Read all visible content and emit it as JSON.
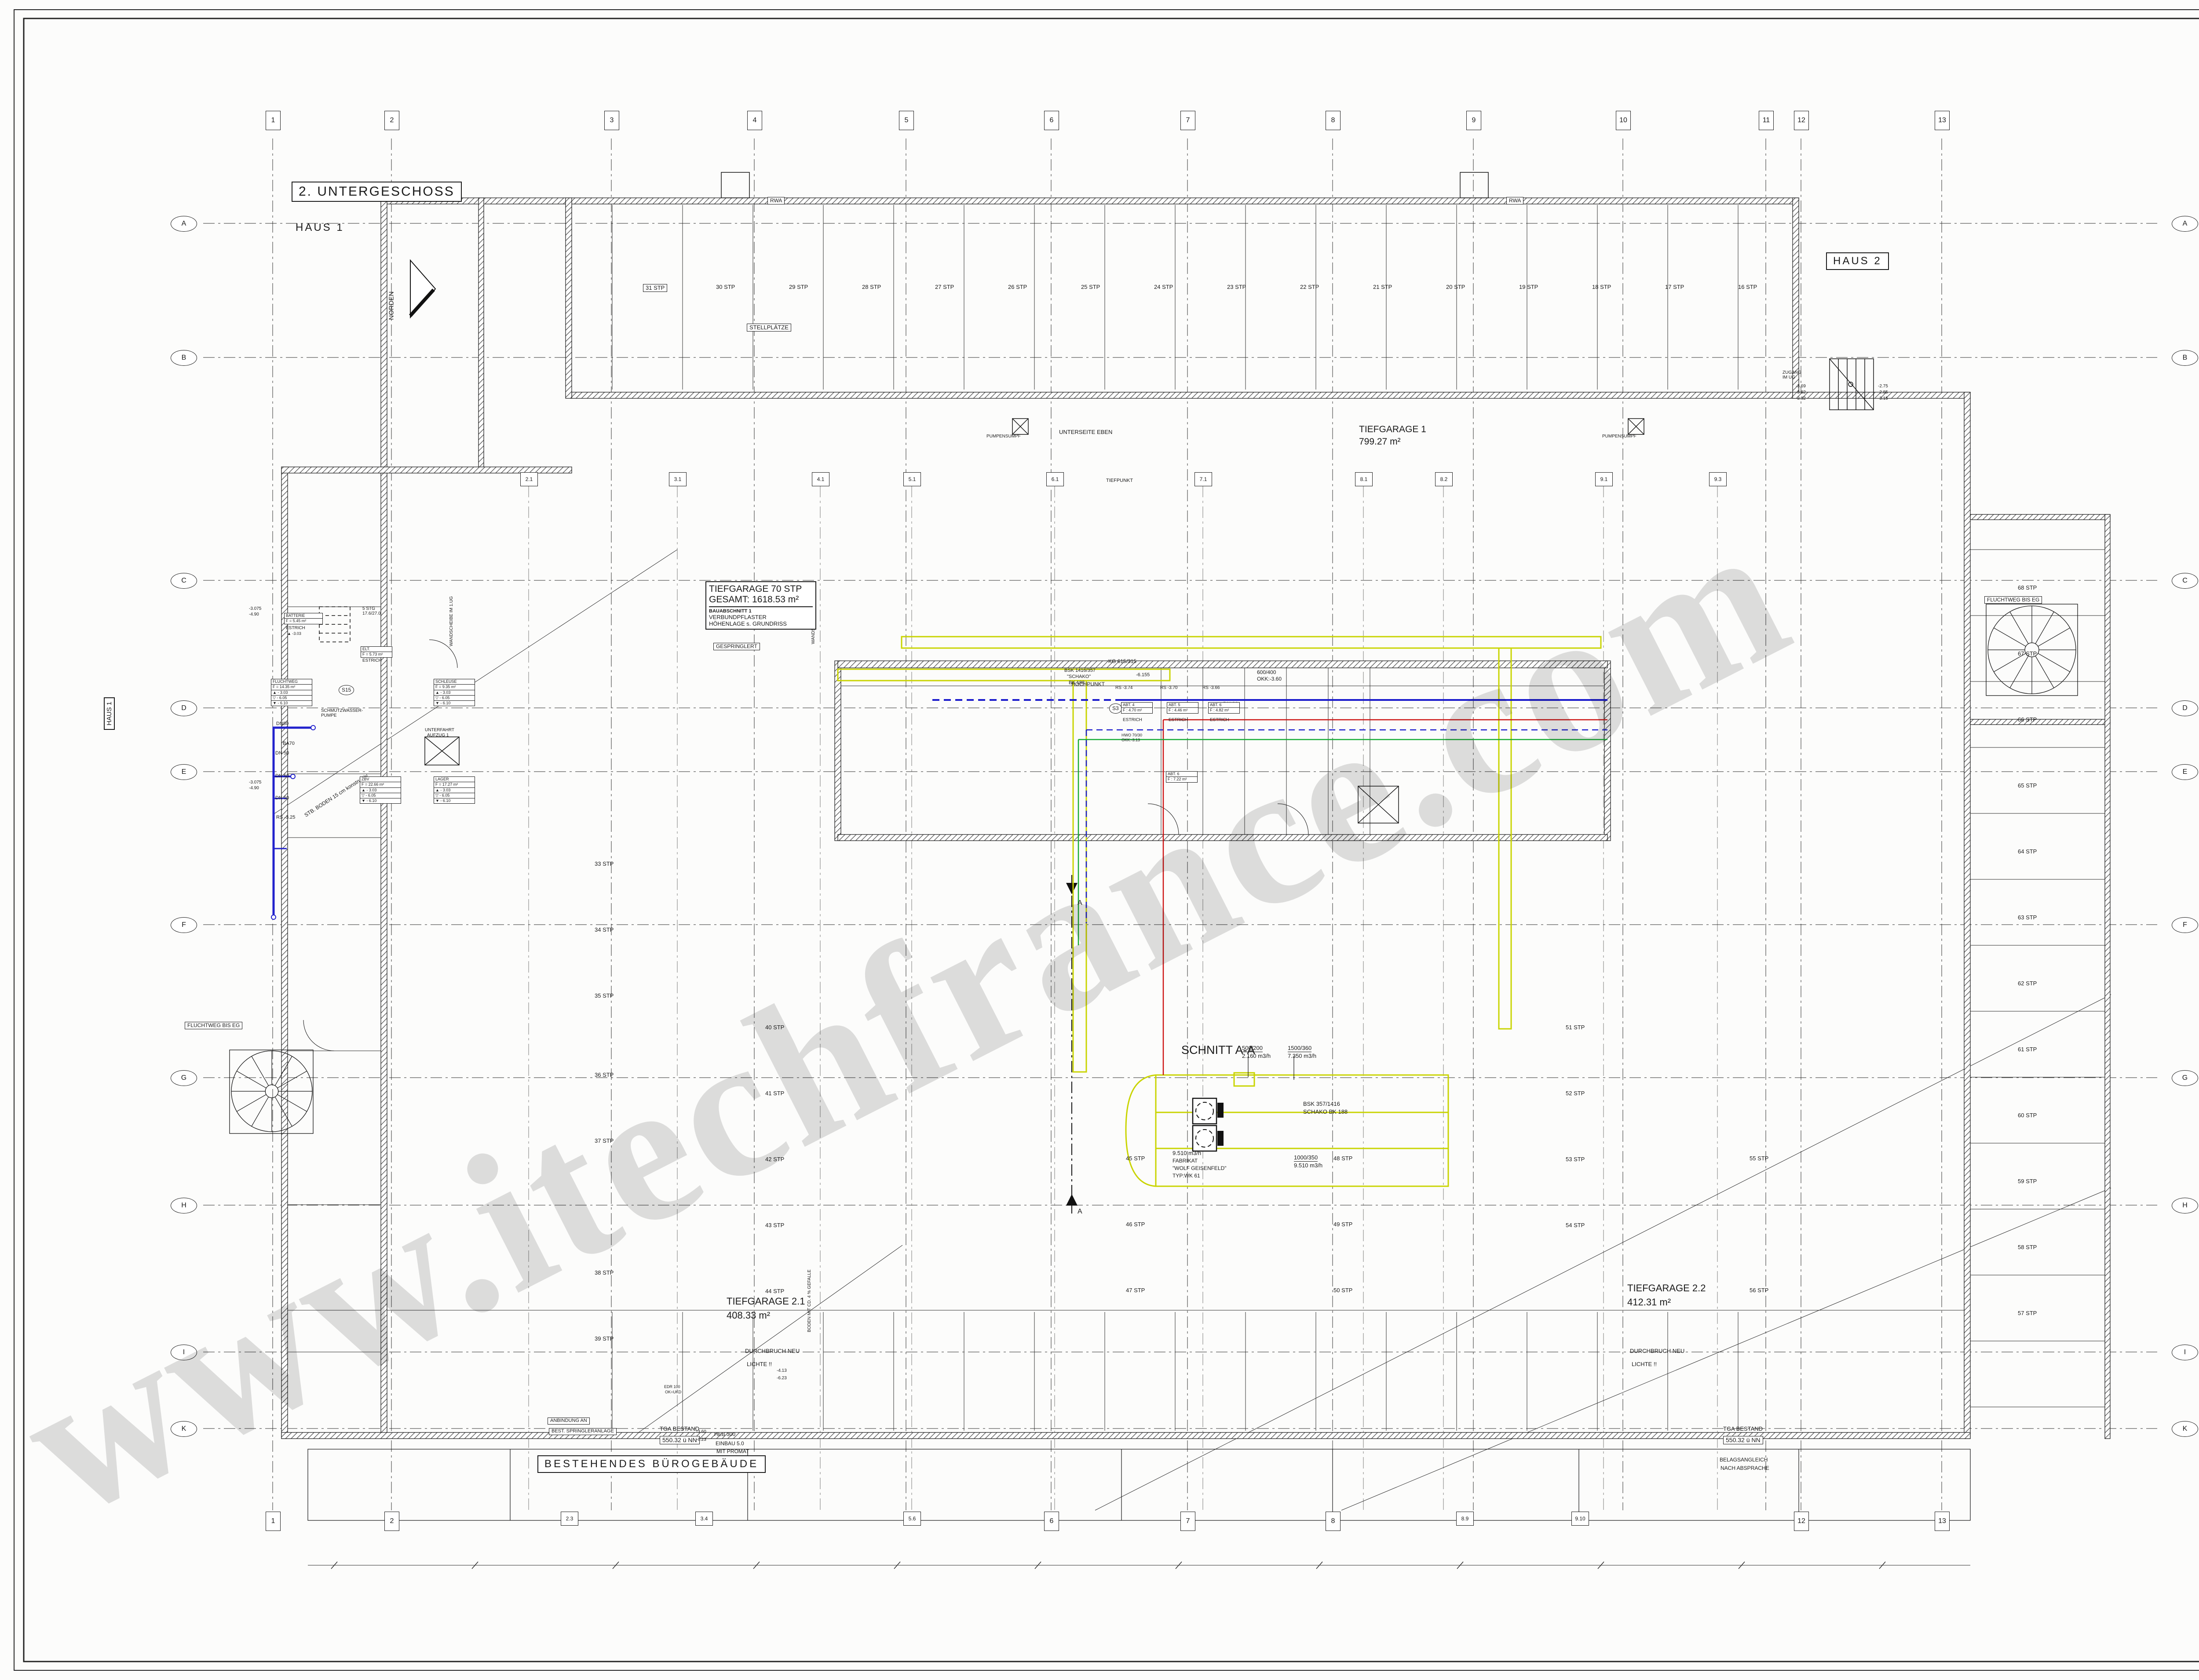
{
  "sheet": {
    "floor_title": "2. UNTERGESCHOSS",
    "haus1": "HAUS 1",
    "haus1_side": "HAUS 1",
    "haus2": "HAUS 2",
    "norden": "NORDEN",
    "bestand": "BESTEHENDES  BÜROGEBÄUDE"
  },
  "grid": {
    "top": [
      "1",
      "2",
      "3",
      "4",
      "5",
      "6",
      "7",
      "8",
      "9",
      "10",
      "11",
      "12",
      "13"
    ],
    "bottom": [
      "1",
      "2",
      "2.3",
      "3.4",
      "5.6",
      "6",
      "7",
      "8",
      "8.9",
      "9.10",
      "12",
      "13"
    ],
    "mid": [
      "2.1",
      "3.1",
      "4.1",
      "5.1",
      "6.1",
      "7.1",
      "8.1",
      "8.2",
      "9.1",
      "9.3"
    ],
    "left": [
      "A",
      "B",
      "C",
      "D",
      "E",
      "F",
      "G",
      "H",
      "I",
      "K"
    ],
    "right": [
      "A",
      "B",
      "C",
      "D",
      "E",
      "F",
      "G",
      "H",
      "I",
      "K"
    ]
  },
  "legend": {
    "title": "LEGENDE",
    "heizung": {
      "title": "HEIZUNG",
      "vl_tag": "VL",
      "rl_tag": "RL",
      "rows": [
        "VORLAUF  - HEIZUNG",
        "RÜCKLAUF - HEIZUNG",
        "HEIZFLÄCHEN",
        "HEIZKREISVERTEILER",
        "ABSPERRUNG"
      ]
    },
    "sanitar": {
      "title": "SANITAR",
      "pipes": [
        {
          "tag": "RR",
          "label": "REGENWASSER"
        },
        {
          "tag": "SW",
          "label": "SCHMUTZWASSER"
        },
        {
          "tag": "SF",
          "label": "SCHMUTZWASSERENTLUFTUNG"
        },
        {
          "tag": "TWK",
          "label": "TRINKWASSER"
        },
        {
          "tag": "TWW",
          "label": "WARMWASSER"
        },
        {
          "tag": "TWZ",
          "label": "WARMWASSERZIRKULATION"
        },
        {
          "tag": "SPR",
          "label": "SPRINKLER"
        }
      ],
      "ba_tag": "BA100",
      "bodenablauf": "BODENABLAUF",
      "absperrung": "ABSPERRUNG"
    },
    "lueftung": {
      "title": "LUEFTUNG",
      "abl_tag": "ABL.400/100",
      "d_tag": "D 100",
      "rows": [
        "ABLUFT+FORTLUFT KANAL/ROHR",
        "BRANDSCHUTZKLAPPE (BSK)",
        "ENTLUFTUNGSGERAT"
      ]
    }
  },
  "plan": {
    "tg70": [
      "TIEFGARAGE  70 STP",
      "GESAMT: 1618.53 m²",
      "BAUABSCHNITT 1",
      "VERBUNDPFLASTER",
      "HÖHENLAGE  s. GRUNDRISS"
    ],
    "rooms": [
      {
        "lines": [
          "BATTERIE",
          "F = 5.45 m²"
        ]
      },
      {
        "lines": [
          "ELT.",
          "F = 5.73 m²"
        ]
      },
      {
        "lines": [
          "FLUCHTWEG",
          "F = 14.35 m²",
          "▲  - 3.03",
          "▽  - 6.05",
          "▼  - 6.10"
        ]
      },
      {
        "lines": [
          "SCHLEUSE",
          "F = 9.35 m²",
          "▲  - 3.03",
          "▽  - 6.05",
          "▼  - 6.10"
        ]
      },
      {
        "lines": [
          "ZBV",
          "F = 22.66 m²",
          "▲  - 3.03",
          "▽  - 6.05",
          "▼  - 6.10"
        ]
      },
      {
        "lines": [
          "LAGER",
          "F = 17.27 m²",
          "▲  - 3.03",
          "▽  - 6.05",
          "▼  - 6.10"
        ]
      },
      {
        "lines": [
          "ABT. 4",
          "F : 4.70 m²"
        ]
      },
      {
        "lines": [
          "ABT. 5",
          "F : 4.46 m²"
        ]
      },
      {
        "lines": [
          "ABT. 6",
          "F : 4.82 m²"
        ]
      },
      {
        "lines": [
          "ABT. 6",
          "F : 7.22 m²"
        ]
      }
    ],
    "stalls": {
      "top": [
        "31 STP",
        "30 STP",
        "29 STP",
        "28 STP",
        "27 STP",
        "26 STP",
        "25 STP",
        "24 STP",
        "23 STP",
        "22 STP",
        "21 STP",
        "20 STP",
        "19 STP",
        "18 STP",
        "17 STP",
        "16 STP"
      ],
      "right": [
        "68 STP",
        "67 STP",
        "66 STP",
        "65 STP",
        "64 STP",
        "63 STP",
        "62 STP",
        "61 STP",
        "60 STP",
        "59 STP",
        "58 STP",
        "57 STP"
      ],
      "scattered": [
        "33 STP",
        "34 STP",
        "35 STP",
        "36 STP",
        "37 STP",
        "38 STP",
        "39 STP",
        "40 STP",
        "41 STP",
        "42 STP",
        "43 STP",
        "44 STP",
        "45 STP",
        "46 STP",
        "47 STP",
        "48 STP",
        "49 STP",
        "50 STP",
        "51 STP",
        "52 STP",
        "53 STP",
        "54 STP",
        "55 STP",
        "56 STP"
      ]
    },
    "notes": [
      "UNTERSEITE EBEN",
      "TIEFPUNKT",
      "HOCHPUNKT",
      "KG 615/315",
      "BSK 1416/357",
      "\"SCHAKO\"",
      "BK 188",
      "RS -3.74",
      "RS -3.70",
      "RS -3.66",
      "-6.155",
      "600/400",
      "OKK:-3.60",
      "DN 80",
      "HWO 70/30",
      "OKK:-3.13",
      "DN80",
      "BA70",
      "DN 50",
      "DN 50",
      "DN 50",
      "RS -3.25",
      "SCHMUTZWASSER-",
      "PUMPE",
      "5 STG",
      "17.6/27.0",
      "ZUGANG",
      "IM UG",
      "-3.69",
      "-3.82",
      "-3.92",
      "-2.75",
      "-2.85",
      "-3.15",
      "WANDSCHEIBE IM 1.UG",
      "WANDSCHEIBE IM 1.UG",
      "BODEN MIT CD. 4 % GEFALLE",
      "DURCHBRUCH NEU",
      "LICHTE !!",
      "-4.13",
      "-6.23",
      "DURCHBRUCH NEU",
      "LICHTE !!",
      "TGA BESTAND",
      "550.32 ü NN",
      "-3.60",
      "-6.23",
      "BELAGSANGLEICH",
      "NACH ABSPRACHE",
      "HEB 300",
      "EINBAU 5.0",
      "MIT PROMAT",
      "AUFLAGER",
      "ANBINDUNG AN",
      "BEST. SPRINGLERANLAGE",
      "TGA BESTAND",
      "550.32 ü NN",
      "BELAGSANGLEICH",
      "NACH ABSPRACHE",
      "FLUCHTWEG BIS EG",
      "FLUCHTWEG BIS EG",
      "STB. BODEN  15 cm  konstruktiv",
      "RWA",
      "RWA",
      "PUMPENSUMPF",
      "PUMPENSUMPF",
      "STELLPLÄTZE",
      "-3.075",
      "-4.90",
      "-3.075",
      "-4.90",
      "S15",
      "S3",
      "500/200",
      "2.160 m3/h",
      "1500/360",
      "7.350 m3/h",
      "BSK 357/1416",
      "SCHAKO BK 188",
      "9.510 m3/h",
      "FABRIKAT",
      "\"WOLF GEISENFELD\"",
      "TYP:WK 61",
      "1000/350",
      "9.510 m3/h",
      "EDR 100",
      "OK=UKD",
      "TIEFGARAGE 1",
      "799.27 m²",
      "TIEFGARAGE 2.1",
      "408.33 m²",
      "TIEFGARAGE 2.2",
      "412.31 m²",
      "SCHNITT A-A",
      "GESPRINGLERT",
      "NATURSTEIN",
      "ESTRICH",
      "▲ -3.03",
      "ESTRICH",
      "ESTRICH",
      "ESTRICH",
      "ESTRICH",
      "ESTRICH",
      "ESTRICH",
      "ESTRICH",
      "UNTERFAHRT",
      "AUFZUG 1",
      "A",
      "A"
    ]
  },
  "watermark": "www.itechfrance.com"
}
